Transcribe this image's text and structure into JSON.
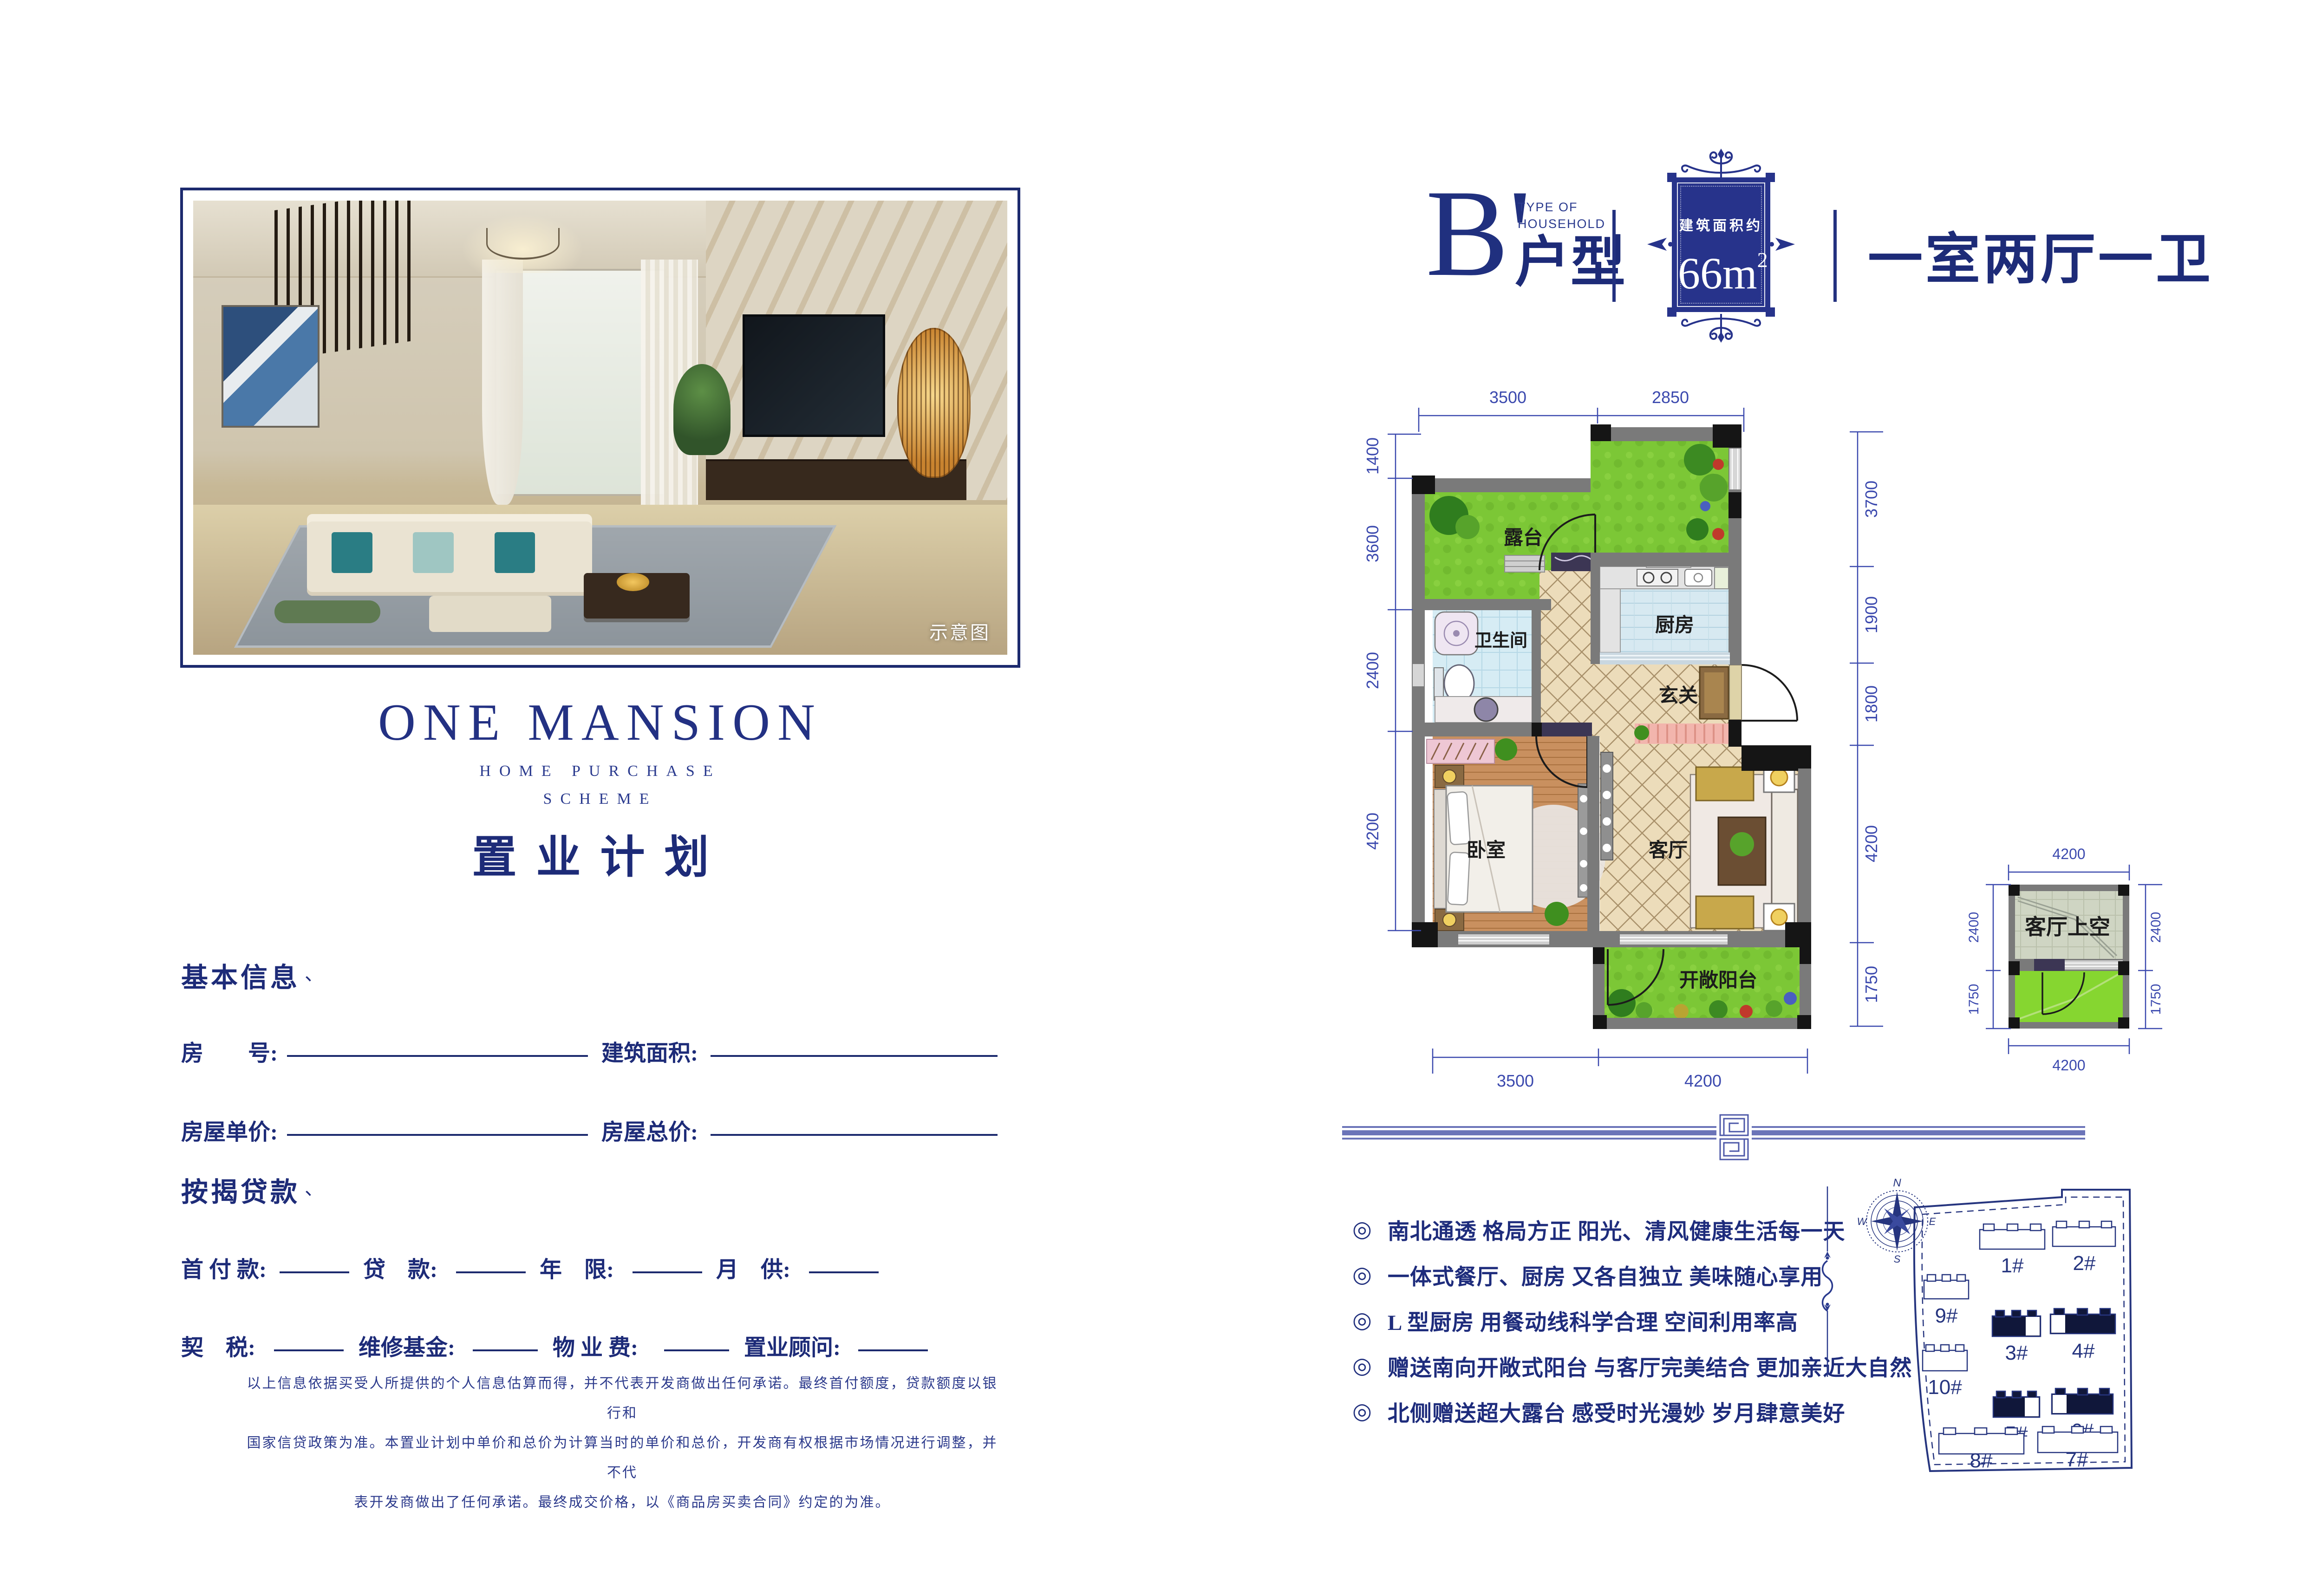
{
  "left_page": {
    "photo_caption": "示意图",
    "brand_title": "ONE MANSION",
    "brand_sub1": "HOME PURCHASE",
    "brand_sub2": "SCHEME",
    "cn_title": "置业计划",
    "basic": {
      "title": "基本信息",
      "tick": "、",
      "row1_f1": "房　　号:",
      "row1_f2": "建筑面积:",
      "row2_f1": "房屋单价:",
      "row2_f2": "房屋总价:"
    },
    "mortgage": {
      "title": "按揭贷款",
      "tick": "、",
      "row1": [
        "首 付 款:",
        "贷　款:",
        "年　限:",
        "月　供:"
      ],
      "row2": [
        "契　税:",
        "维修基金:",
        "物 业 费:",
        "置业顾问:"
      ]
    },
    "disclaimer": [
      "以上信息依据买受人所提供的个人信息估算而得，并不代表开发商做出任何承诺。最终首付额度，贷款额度以银行和",
      "国家信贷政策为准。本置业计划中单价和总价为计算当时的单价和总价，开发商有权根据市场情况进行调整，并不代",
      "表开发商做出了任何承诺。最终成交价格，以《商品房买卖合同》约定的为准。"
    ]
  },
  "right_page": {
    "header": {
      "code": "B'",
      "en1": "TYPE OF",
      "en2": "HOUSEHOLD",
      "cn": "户型",
      "area_caption": "建筑面积约",
      "area_num": "66m",
      "area_sup": "2",
      "layout": "一室两厅一卫"
    },
    "plan": {
      "rooms": {
        "terrace": "露台",
        "bath": "卫生间",
        "kitchen": "厨房",
        "entry": "玄关",
        "bedroom": "卧室",
        "living": "客厅",
        "balcony": "开敞阳台"
      },
      "dims": {
        "top": [
          "3500",
          "2850"
        ],
        "bottom": [
          "3500",
          "4200"
        ],
        "left": [
          "1400",
          "3600",
          "2400",
          "4200"
        ],
        "right": [
          "3700",
          "1900",
          "1800",
          "4200",
          "1750"
        ]
      }
    },
    "upper_plan": {
      "label": "客厅上空",
      "dim_top": "4200",
      "dim_bottom": "4200",
      "left": [
        "2400",
        "1750"
      ],
      "right": [
        "2400",
        "1750"
      ]
    },
    "features": {
      "marker": "◎",
      "items": [
        "南北通透 格局方正 阳光、清风健康生活每一天",
        "一体式餐厅、厨房 又各自独立 美味随心享用",
        "L 型厨房 用餐动线科学合理 空间利用率高",
        "赠送南向开敞式阳台 与客厅完美结合 更加亲近大自然",
        "北侧赠送超大露台 感受时光漫妙 岁月肆意美好"
      ]
    },
    "site": {
      "compass": {
        "n": "N",
        "e": "E",
        "s": "S",
        "w": "W"
      },
      "buildings": [
        {
          "id": "1#",
          "fill": "#ffffff",
          "al": "none",
          "ar": "none"
        },
        {
          "id": "2#",
          "fill": "#ffffff",
          "al": "none",
          "ar": "none"
        },
        {
          "id": "9#",
          "fill": "#ffffff",
          "al": "none",
          "ar": "none"
        },
        {
          "id": "3#",
          "fill": "#10173a",
          "al": "none",
          "ar": "#ffffff"
        },
        {
          "id": "4#",
          "fill": "#10173a",
          "al": "#ffffff",
          "ar": "none"
        },
        {
          "id": "10#",
          "fill": "#ffffff",
          "al": "none",
          "ar": "none"
        },
        {
          "id": "5#",
          "fill": "#10173a",
          "al": "none",
          "ar": "#ffffff"
        },
        {
          "id": "6#",
          "fill": "#10173a",
          "al": "#ffffff",
          "ar": "none"
        },
        {
          "id": "8#",
          "fill": "#ffffff",
          "al": "none",
          "ar": "none"
        },
        {
          "id": "7#",
          "fill": "#ffffff",
          "al": "none",
          "ar": "none"
        }
      ]
    }
  }
}
